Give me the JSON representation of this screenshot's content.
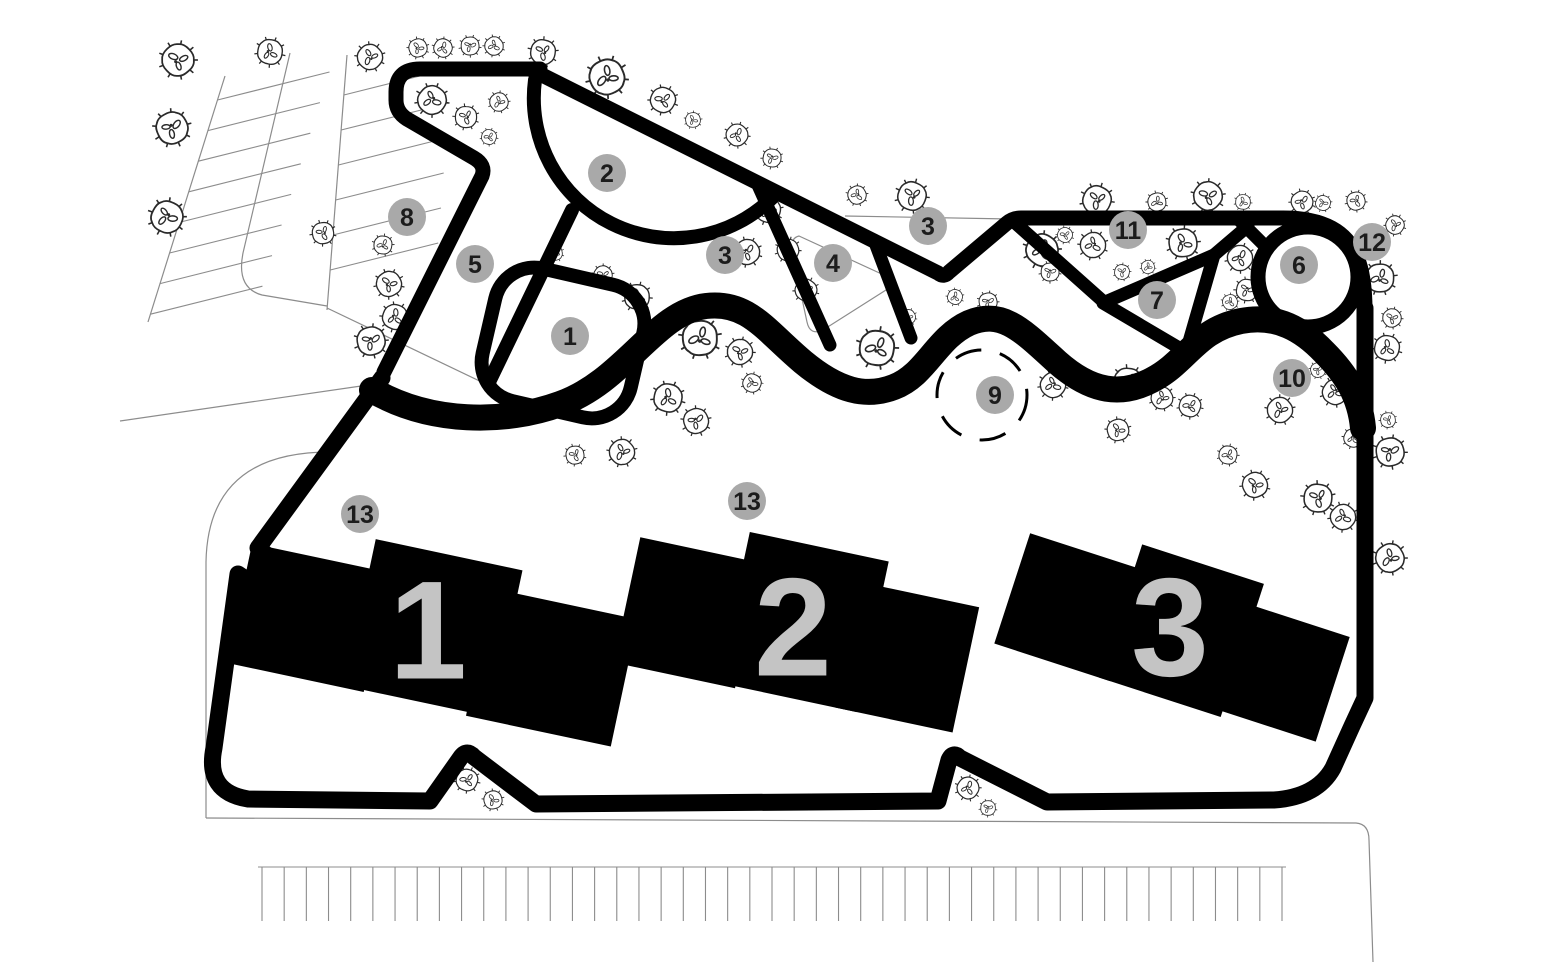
{
  "page": {
    "background": "#ffffff",
    "width": 1560,
    "height": 964,
    "title": "Site plan with three numbered buildings and landscape area markers"
  },
  "plan": {
    "markers": [
      {
        "label": "1",
        "x": 570,
        "y": 336
      },
      {
        "label": "2",
        "x": 607,
        "y": 173
      },
      {
        "label": "3",
        "x": 725,
        "y": 255
      },
      {
        "label": "3",
        "x": 928,
        "y": 226
      },
      {
        "label": "4",
        "x": 833,
        "y": 263
      },
      {
        "label": "5",
        "x": 475,
        "y": 264
      },
      {
        "label": "6",
        "x": 1299,
        "y": 265
      },
      {
        "label": "7",
        "x": 1157,
        "y": 300
      },
      {
        "label": "8",
        "x": 407,
        "y": 217
      },
      {
        "label": "9",
        "x": 995,
        "y": 395
      },
      {
        "label": "10",
        "x": 1292,
        "y": 378
      },
      {
        "label": "11",
        "x": 1128,
        "y": 230
      },
      {
        "label": "12",
        "x": 1372,
        "y": 242
      },
      {
        "label": "13",
        "x": 360,
        "y": 514
      },
      {
        "label": "13",
        "x": 747,
        "y": 501
      }
    ],
    "buildings": [
      {
        "label": "1",
        "cx": 428,
        "cy": 630,
        "rotate": 12
      },
      {
        "label": "2",
        "cx": 793,
        "cy": 627,
        "rotate": 12
      },
      {
        "label": "3",
        "cx": 1170,
        "cy": 627,
        "rotate": 18
      }
    ],
    "dashed_circle": {
      "x": 982,
      "y": 395,
      "r": 45
    },
    "parking_bottom": {
      "count": 47,
      "x_start": 262,
      "x_end": 1282,
      "y_top": 867,
      "y_bottom": 921
    },
    "parking_top_left": {
      "row1_count": 8,
      "row2_count": 6
    },
    "trees": [
      [
        178,
        60,
        19
      ],
      [
        270,
        52,
        15
      ],
      [
        172,
        128,
        19
      ],
      [
        167,
        217,
        19
      ],
      [
        323,
        233,
        13
      ],
      [
        370,
        57,
        15
      ],
      [
        383,
        245,
        11
      ],
      [
        389,
        284,
        15
      ],
      [
        395,
        317,
        15
      ],
      [
        371,
        341,
        17
      ],
      [
        432,
        100,
        17
      ],
      [
        466,
        117,
        13
      ],
      [
        499,
        102,
        11
      ],
      [
        489,
        137,
        9
      ],
      [
        418,
        48,
        11
      ],
      [
        443,
        48,
        11
      ],
      [
        470,
        46,
        11
      ],
      [
        494,
        46,
        11
      ],
      [
        543,
        52,
        15
      ],
      [
        607,
        77,
        21
      ],
      [
        663,
        100,
        15
      ],
      [
        693,
        120,
        9
      ],
      [
        737,
        135,
        13
      ],
      [
        772,
        158,
        11
      ],
      [
        857,
        195,
        11
      ],
      [
        912,
        196,
        17
      ],
      [
        555,
        253,
        9
      ],
      [
        603,
        275,
        11
      ],
      [
        637,
        297,
        15
      ],
      [
        747,
        252,
        15
      ],
      [
        768,
        210,
        15
      ],
      [
        788,
        250,
        13
      ],
      [
        806,
        290,
        13
      ],
      [
        700,
        338,
        21
      ],
      [
        740,
        352,
        15
      ],
      [
        668,
        398,
        17
      ],
      [
        696,
        421,
        15
      ],
      [
        752,
        383,
        11
      ],
      [
        575,
        455,
        11
      ],
      [
        622,
        452,
        15
      ],
      [
        877,
        348,
        21
      ],
      [
        908,
        317,
        9
      ],
      [
        955,
        297,
        9
      ],
      [
        988,
        302,
        11
      ],
      [
        1053,
        385,
        15
      ],
      [
        1128,
        382,
        17
      ],
      [
        1162,
        398,
        13
      ],
      [
        1190,
        406,
        13
      ],
      [
        1118,
        430,
        13
      ],
      [
        1042,
        250,
        19
      ],
      [
        1050,
        272,
        11
      ],
      [
        1093,
        245,
        15
      ],
      [
        1122,
        272,
        9
      ],
      [
        1148,
        267,
        8
      ],
      [
        1065,
        235,
        9
      ],
      [
        1183,
        243,
        17
      ],
      [
        1240,
        258,
        15
      ],
      [
        1247,
        290,
        13
      ],
      [
        1230,
        302,
        9
      ],
      [
        1097,
        200,
        17
      ],
      [
        1157,
        202,
        11
      ],
      [
        1208,
        196,
        17
      ],
      [
        1243,
        202,
        9
      ],
      [
        1302,
        202,
        13
      ],
      [
        1323,
        203,
        9
      ],
      [
        1356,
        201,
        11
      ],
      [
        1395,
        225,
        11
      ],
      [
        1380,
        278,
        17
      ],
      [
        1392,
        318,
        11
      ],
      [
        1387,
        348,
        15
      ],
      [
        1318,
        370,
        9
      ],
      [
        1335,
        392,
        15
      ],
      [
        1388,
        420,
        9
      ],
      [
        1280,
        410,
        15
      ],
      [
        1228,
        455,
        11
      ],
      [
        1255,
        485,
        15
      ],
      [
        1353,
        438,
        11
      ],
      [
        1390,
        452,
        17
      ],
      [
        1343,
        517,
        15
      ],
      [
        1318,
        498,
        17
      ],
      [
        1390,
        558,
        17
      ],
      [
        467,
        780,
        13
      ],
      [
        493,
        800,
        11
      ],
      [
        968,
        788,
        13
      ],
      [
        988,
        808,
        9
      ]
    ],
    "colors": {
      "marker_fill": "#a9a9a9",
      "marker_text": "#1c1c1c",
      "building": "#000000",
      "building_number": "#c4c4c4",
      "path": "#000000",
      "thin_line": "#8c8c8c",
      "tree": "#2a2a2a",
      "background": "#ffffff"
    }
  }
}
